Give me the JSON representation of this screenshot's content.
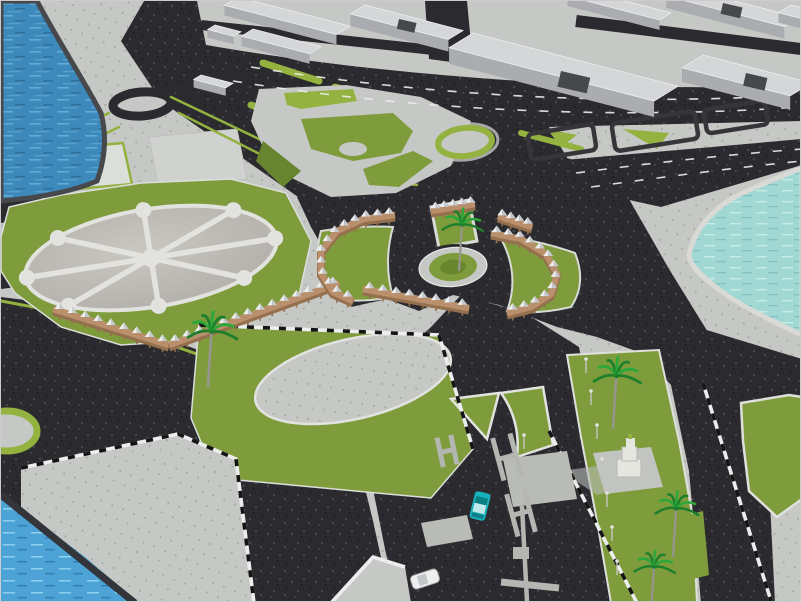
{
  "title": "3D aerial render of an urban corniche plaza master plan with roads, lawns, pergola arcades, palm trees and waterfront",
  "colors": {
    "water_deep": "#3d89bc",
    "water_deep_lite": "#65aad2",
    "water_bright": "#4da3d6",
    "water_bright_lite": "#8fd0ee",
    "water_shallow": "#a2d8d4",
    "water_shallow_lite": "#c6ece8",
    "pavement": "#c6c8c5",
    "pavement_bright": "#dcdeda",
    "pavement_dot": "#a4a6a3",
    "plaza_fill": "#b3afaa",
    "plaza_lite": "#cac6c0",
    "asphalt": "#2b2b2f",
    "asphalt_lite": "#46464e",
    "green": "#7e9c3b",
    "green_bright": "#93b23f",
    "green_dark": "#67842e",
    "palm": "#2ca83a",
    "palm_dark": "#1d7f2b",
    "trunk": "#96968e",
    "tan": "#b98f6c",
    "tan_dark": "#95704f",
    "canopy": "#eceef0",
    "canopy_shade": "#c4c7cc",
    "bld_top": "#d4d6d8",
    "bld_side": "#aaacb0",
    "bld_shadow": "#84878c",
    "roof_patch": "#46484c",
    "curb_white": "#eceded",
    "curb_black": "#141414",
    "lamp": "#c2c4c0",
    "lamp_head": "#e2e3df",
    "car_teal": "#18b2ba",
    "car_teal_dark": "#0c7f86",
    "car_white": "#eef0f0",
    "monument_white": "#e6e6e1",
    "monument_base": "#c2c4c1",
    "white_path": "#e2e3df",
    "quay_wall": "#46484c"
  },
  "scene": {
    "water_bodies": 3,
    "roundabouts": 3,
    "radial_plaza_spokes": 8,
    "pergola_arcades": 7,
    "palm_trees": 5,
    "street_lamps": 8,
    "vehicles": 2,
    "monuments": 1,
    "city_blocks": 10
  }
}
